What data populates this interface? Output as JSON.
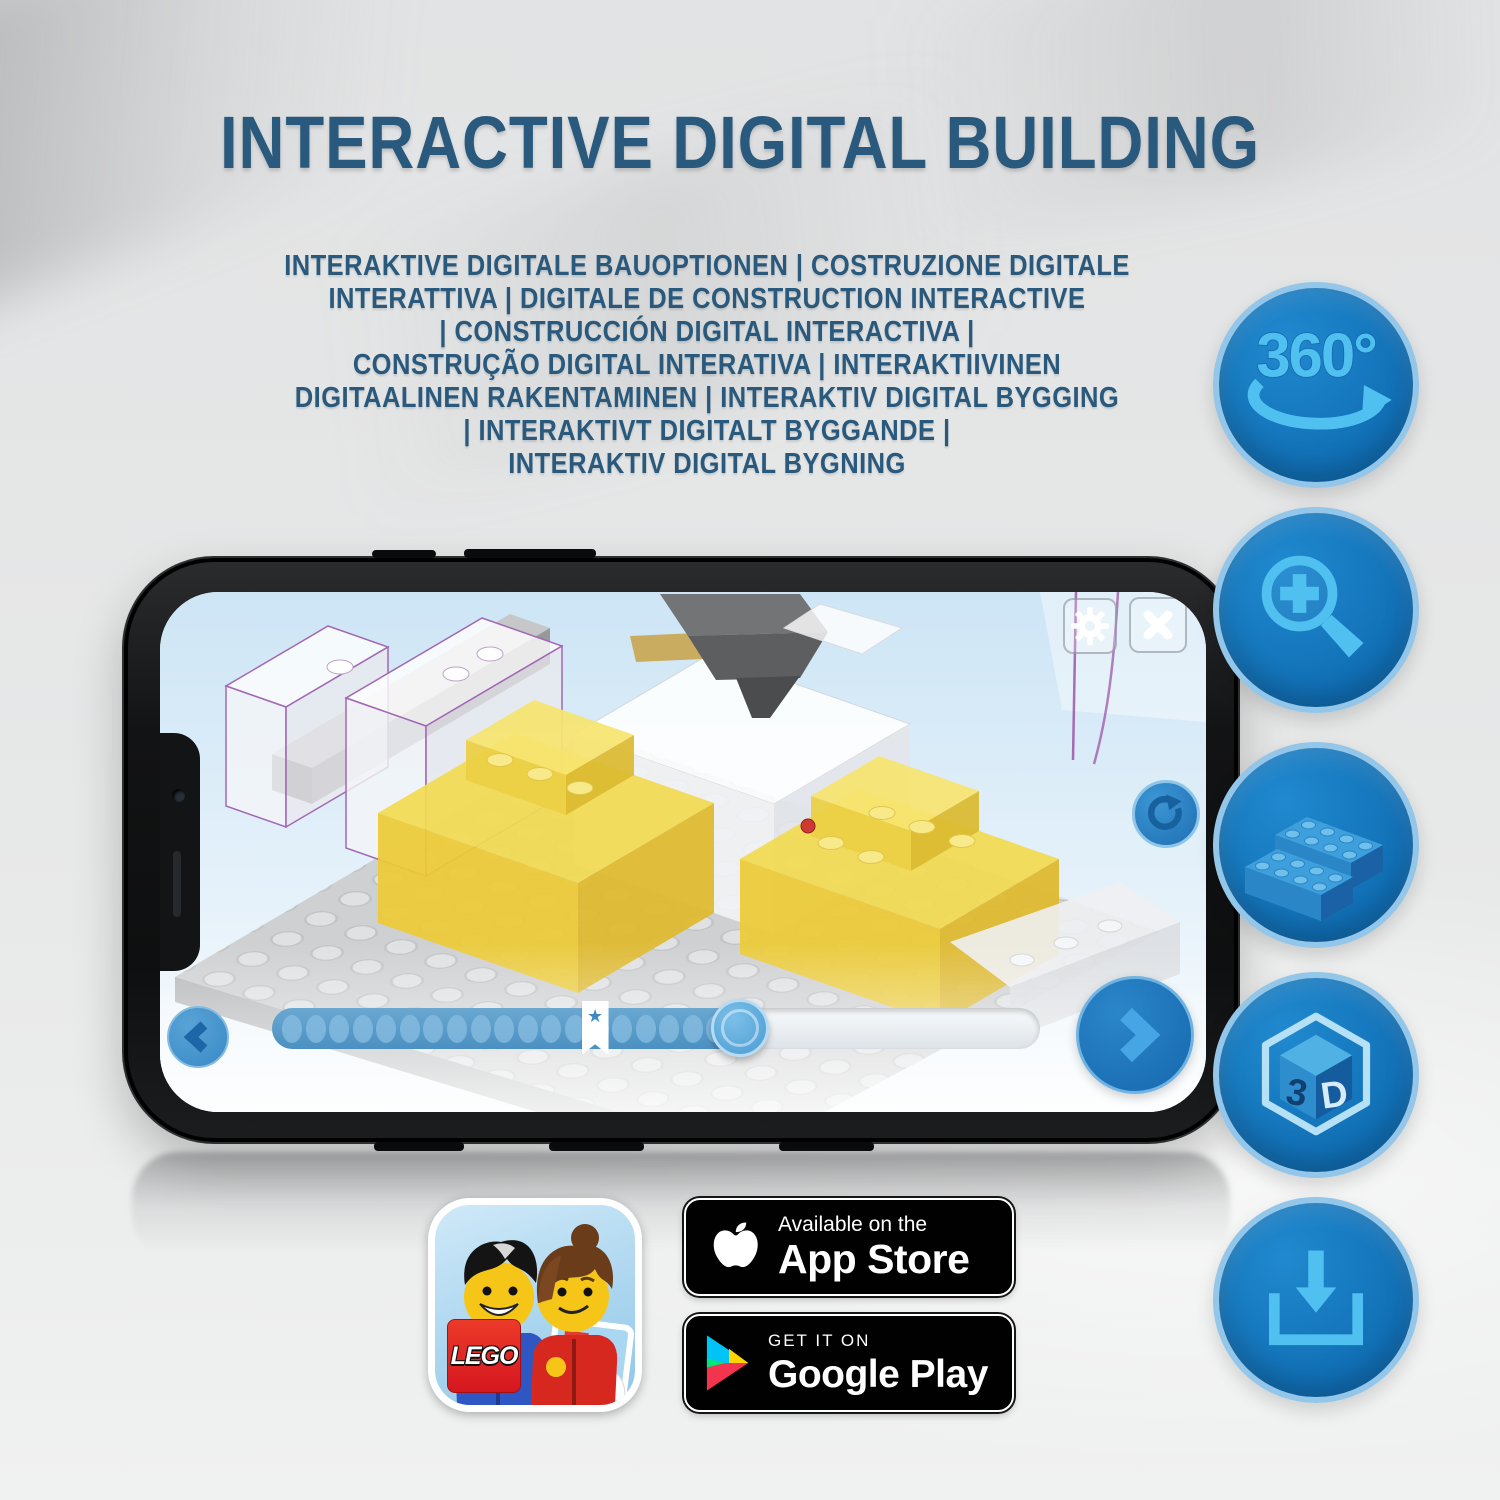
{
  "title": "INTERACTIVE DIGITAL BUILDING",
  "subtitle_lines": [
    "INTERAKTIVE DIGITALE BAUOPTIONEN | COSTRUZIONE DIGITALE",
    "INTERATTIVA | DIGITALE DE CONSTRUCTION INTERACTIVE",
    "| CONSTRUCCIÓN DIGITAL INTERACTIVA |",
    "CONSTRUÇÃO DIGITAL INTERATIVA | INTERAKTIIVINEN",
    "DIGITAALINEN RAKENTAMINEN | INTERAKTIV DIGITAL BYGGING",
    "| INTERAKTIVT DIGITALT BYGGANDE |",
    "INTERAKTIV DIGITAL BYGNING"
  ],
  "feature_icons": [
    {
      "id": "rotate-360",
      "label": "360°"
    },
    {
      "id": "zoom-in"
    },
    {
      "id": "brick-build"
    },
    {
      "id": "view-3d",
      "face_left": "3",
      "face_right": "D"
    },
    {
      "id": "download"
    }
  ],
  "phone_app": {
    "slider": {
      "dots": 19,
      "progress_percent": 61,
      "bookmark_percent": 42
    }
  },
  "badges": {
    "lego_logo": "LEGO",
    "app_store": {
      "tagline": "Available on the",
      "store": "App Store"
    },
    "google_play": {
      "tagline": "GET IT ON",
      "store": "Google Play"
    }
  },
  "colors": {
    "title_blue": "#29597c",
    "circle_blue": "#1173b8",
    "circle_ring": "#93c6e8",
    "icon_light_blue": "#4fc0ef",
    "screen_sky": "#d9eaf6",
    "brick_yellow": "#f0d64a",
    "badge_black": "#010101",
    "lego_red": "#d6171f"
  }
}
